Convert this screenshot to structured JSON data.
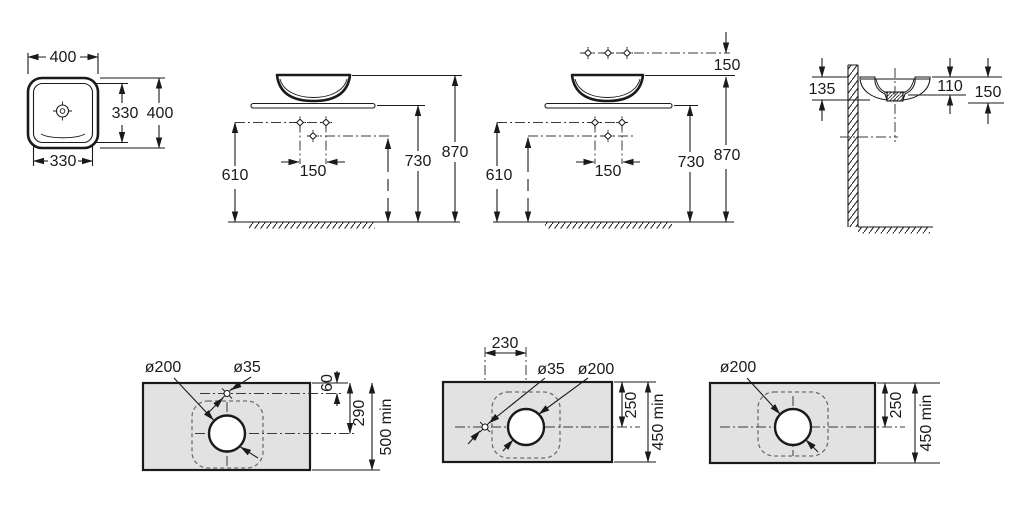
{
  "drawing": {
    "background": "#ffffff",
    "line_color": "#1a1a1a",
    "countertop_fill": "#e2e2e2",
    "views": {
      "plan": {
        "width_top": "400",
        "bowl_height": "330",
        "overall_height": "400",
        "bowl_width": "330"
      },
      "front_a": {
        "drain_height": "610",
        "tap_spacing": "150",
        "counter_height": "730",
        "rim_height": "870"
      },
      "front_b": {
        "wall_tap_offset": "150",
        "drain_height": "610",
        "tap_spacing": "150",
        "counter_height": "730",
        "rim_height": "870"
      },
      "section": {
        "rim_to_base_wall": "135",
        "rim_to_outlet": "110",
        "rim_to_base_front": "150"
      },
      "cutout_a": {
        "drain_dia": "ø200",
        "tap_dia": "ø35",
        "tap_edge_offset": "60",
        "center_edge_offset": "290",
        "min_depth": "500 min"
      },
      "cutout_b": {
        "tap_center_offset": "230",
        "tap_dia": "ø35",
        "drain_dia": "ø200",
        "center_edge_offset": "250",
        "min_depth": "450 min"
      },
      "cutout_c": {
        "drain_dia": "ø200",
        "center_edge_offset": "250",
        "min_depth": "450 min"
      }
    }
  }
}
